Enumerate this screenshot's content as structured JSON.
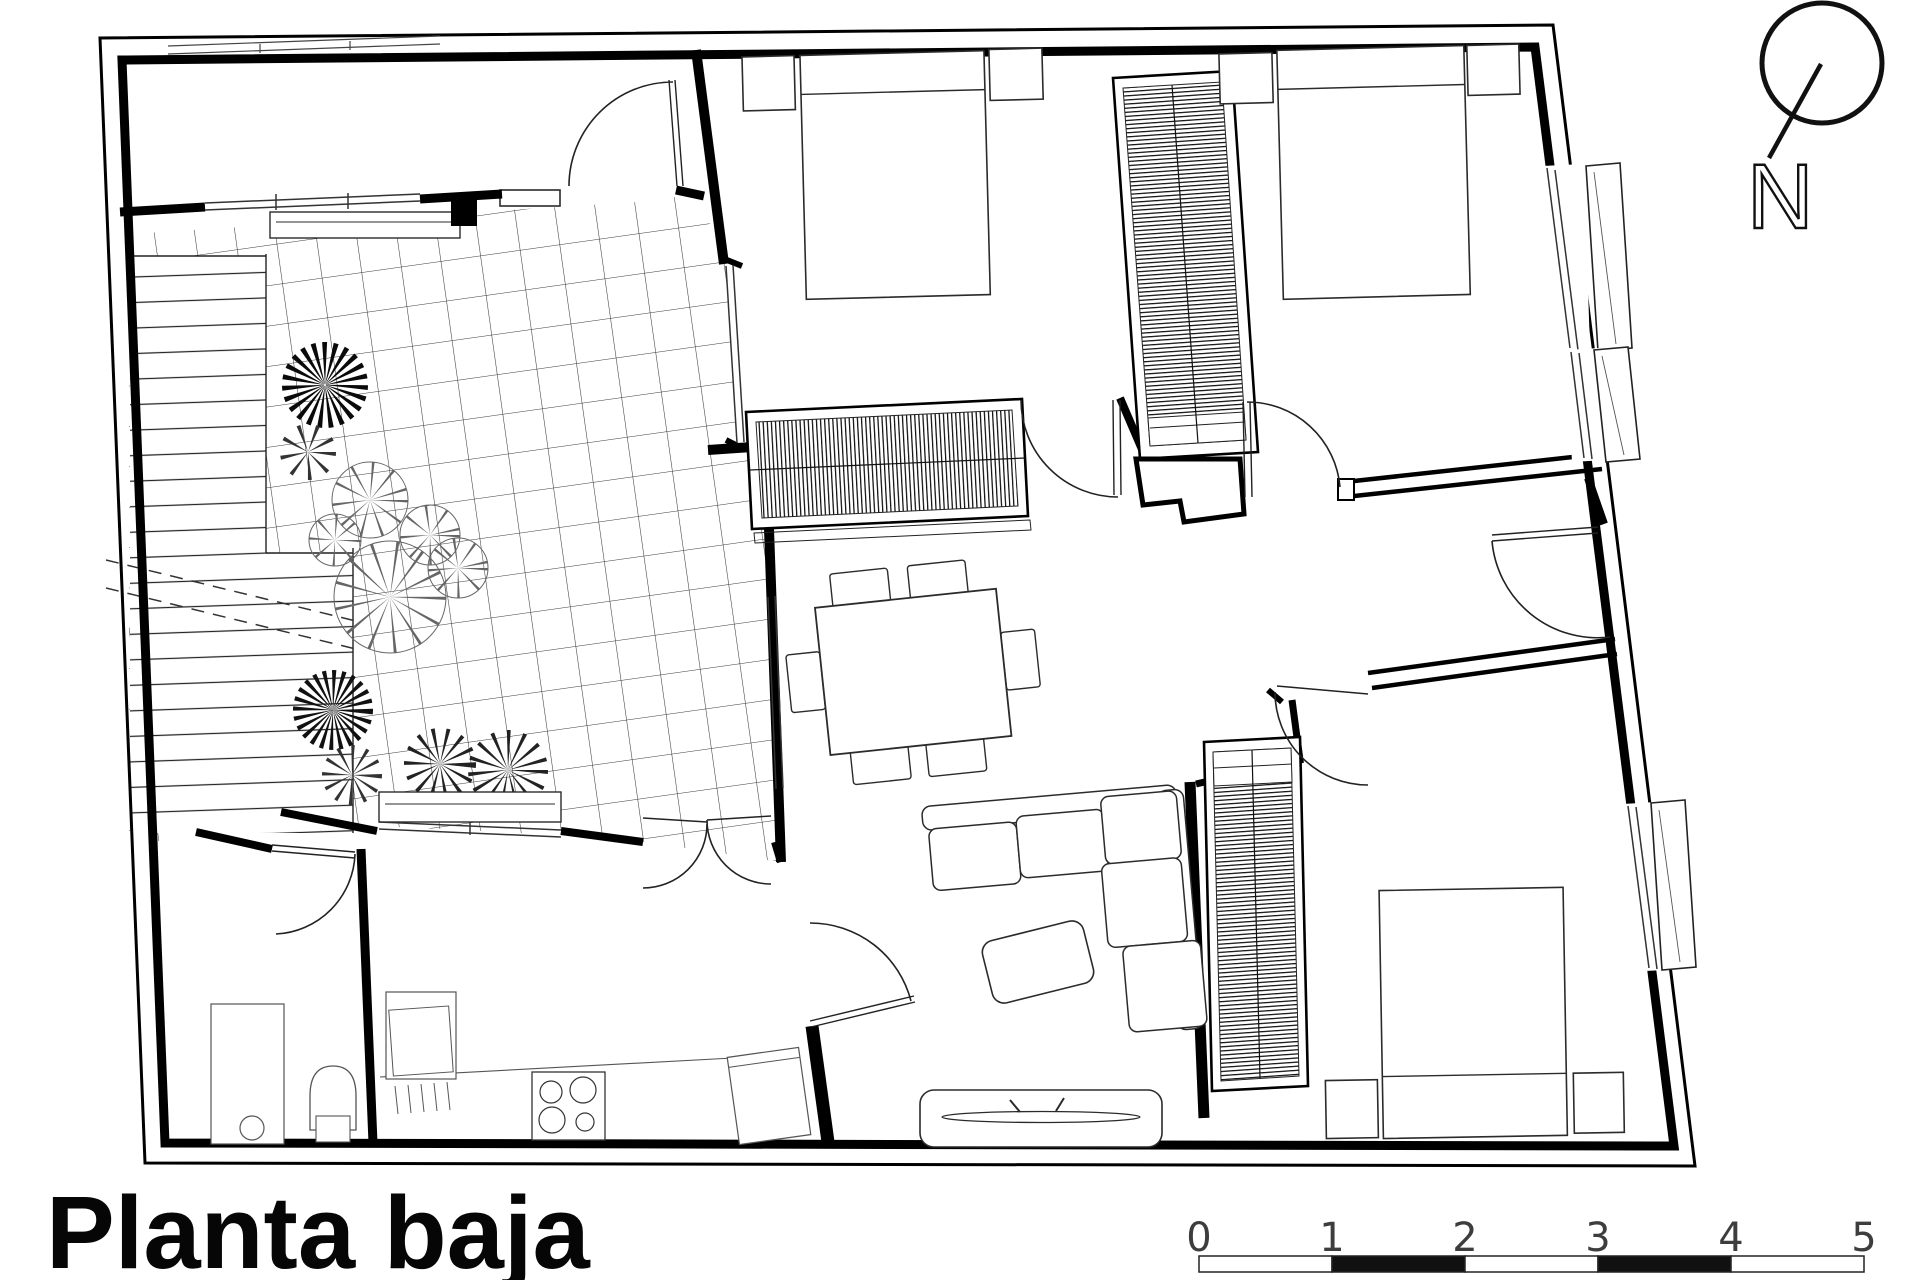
{
  "canvas": {
    "width": 1920,
    "height": 1280,
    "background": "#ffffff",
    "ink": "#111111"
  },
  "title": {
    "text": "Planta baja"
  },
  "north_arrow": {
    "label": "N"
  },
  "scale_bar": {
    "labels": [
      "0",
      "1",
      "2",
      "3",
      "4",
      "5"
    ]
  }
}
